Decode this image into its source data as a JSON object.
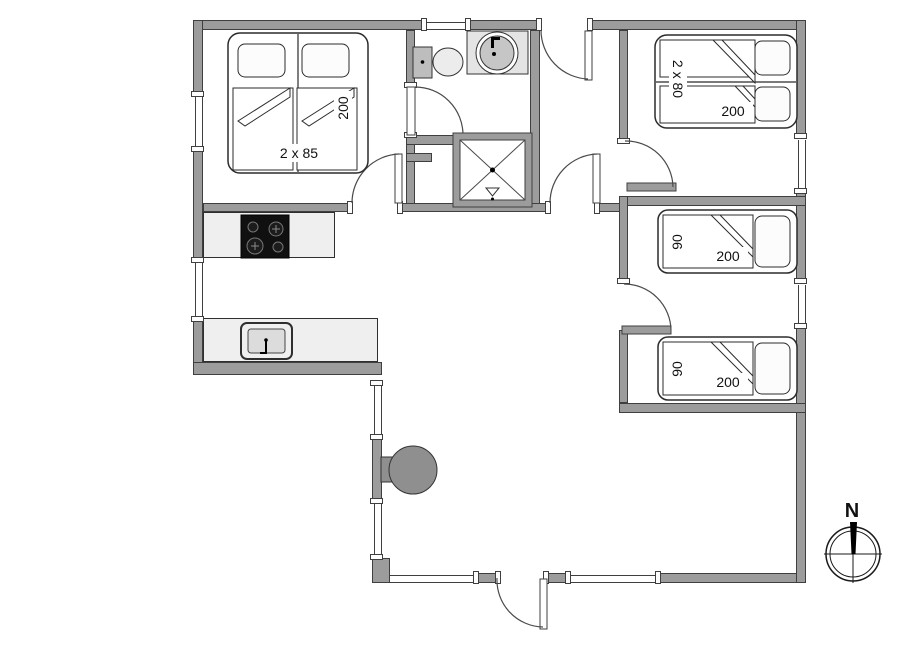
{
  "plan_title": "holiday-house-floor-plan",
  "beds": {
    "bedroom_top_left": {
      "width": "2 x 85",
      "length": "200"
    },
    "bedroom_top_right": {
      "width": "2 x 80",
      "length": "200"
    },
    "bedroom_mid_right": {
      "width": "90",
      "length": "200"
    },
    "bedroom_bottom_right": {
      "width": "90",
      "length": "200"
    }
  },
  "compass": {
    "north": "N"
  },
  "fixtures": {
    "bathroom": [
      "toilet",
      "washbasin",
      "shower"
    ],
    "kitchen": [
      "cooktop",
      "kitchen-sink"
    ],
    "living": [
      "wood-stove"
    ]
  },
  "colors": {
    "wall": "#9c9c9c",
    "wall_outline": "#3f3f3f",
    "counter": "#efefef",
    "cooktop": "#101010",
    "stove": "#8f8f8f",
    "floor": "#ffffff"
  }
}
